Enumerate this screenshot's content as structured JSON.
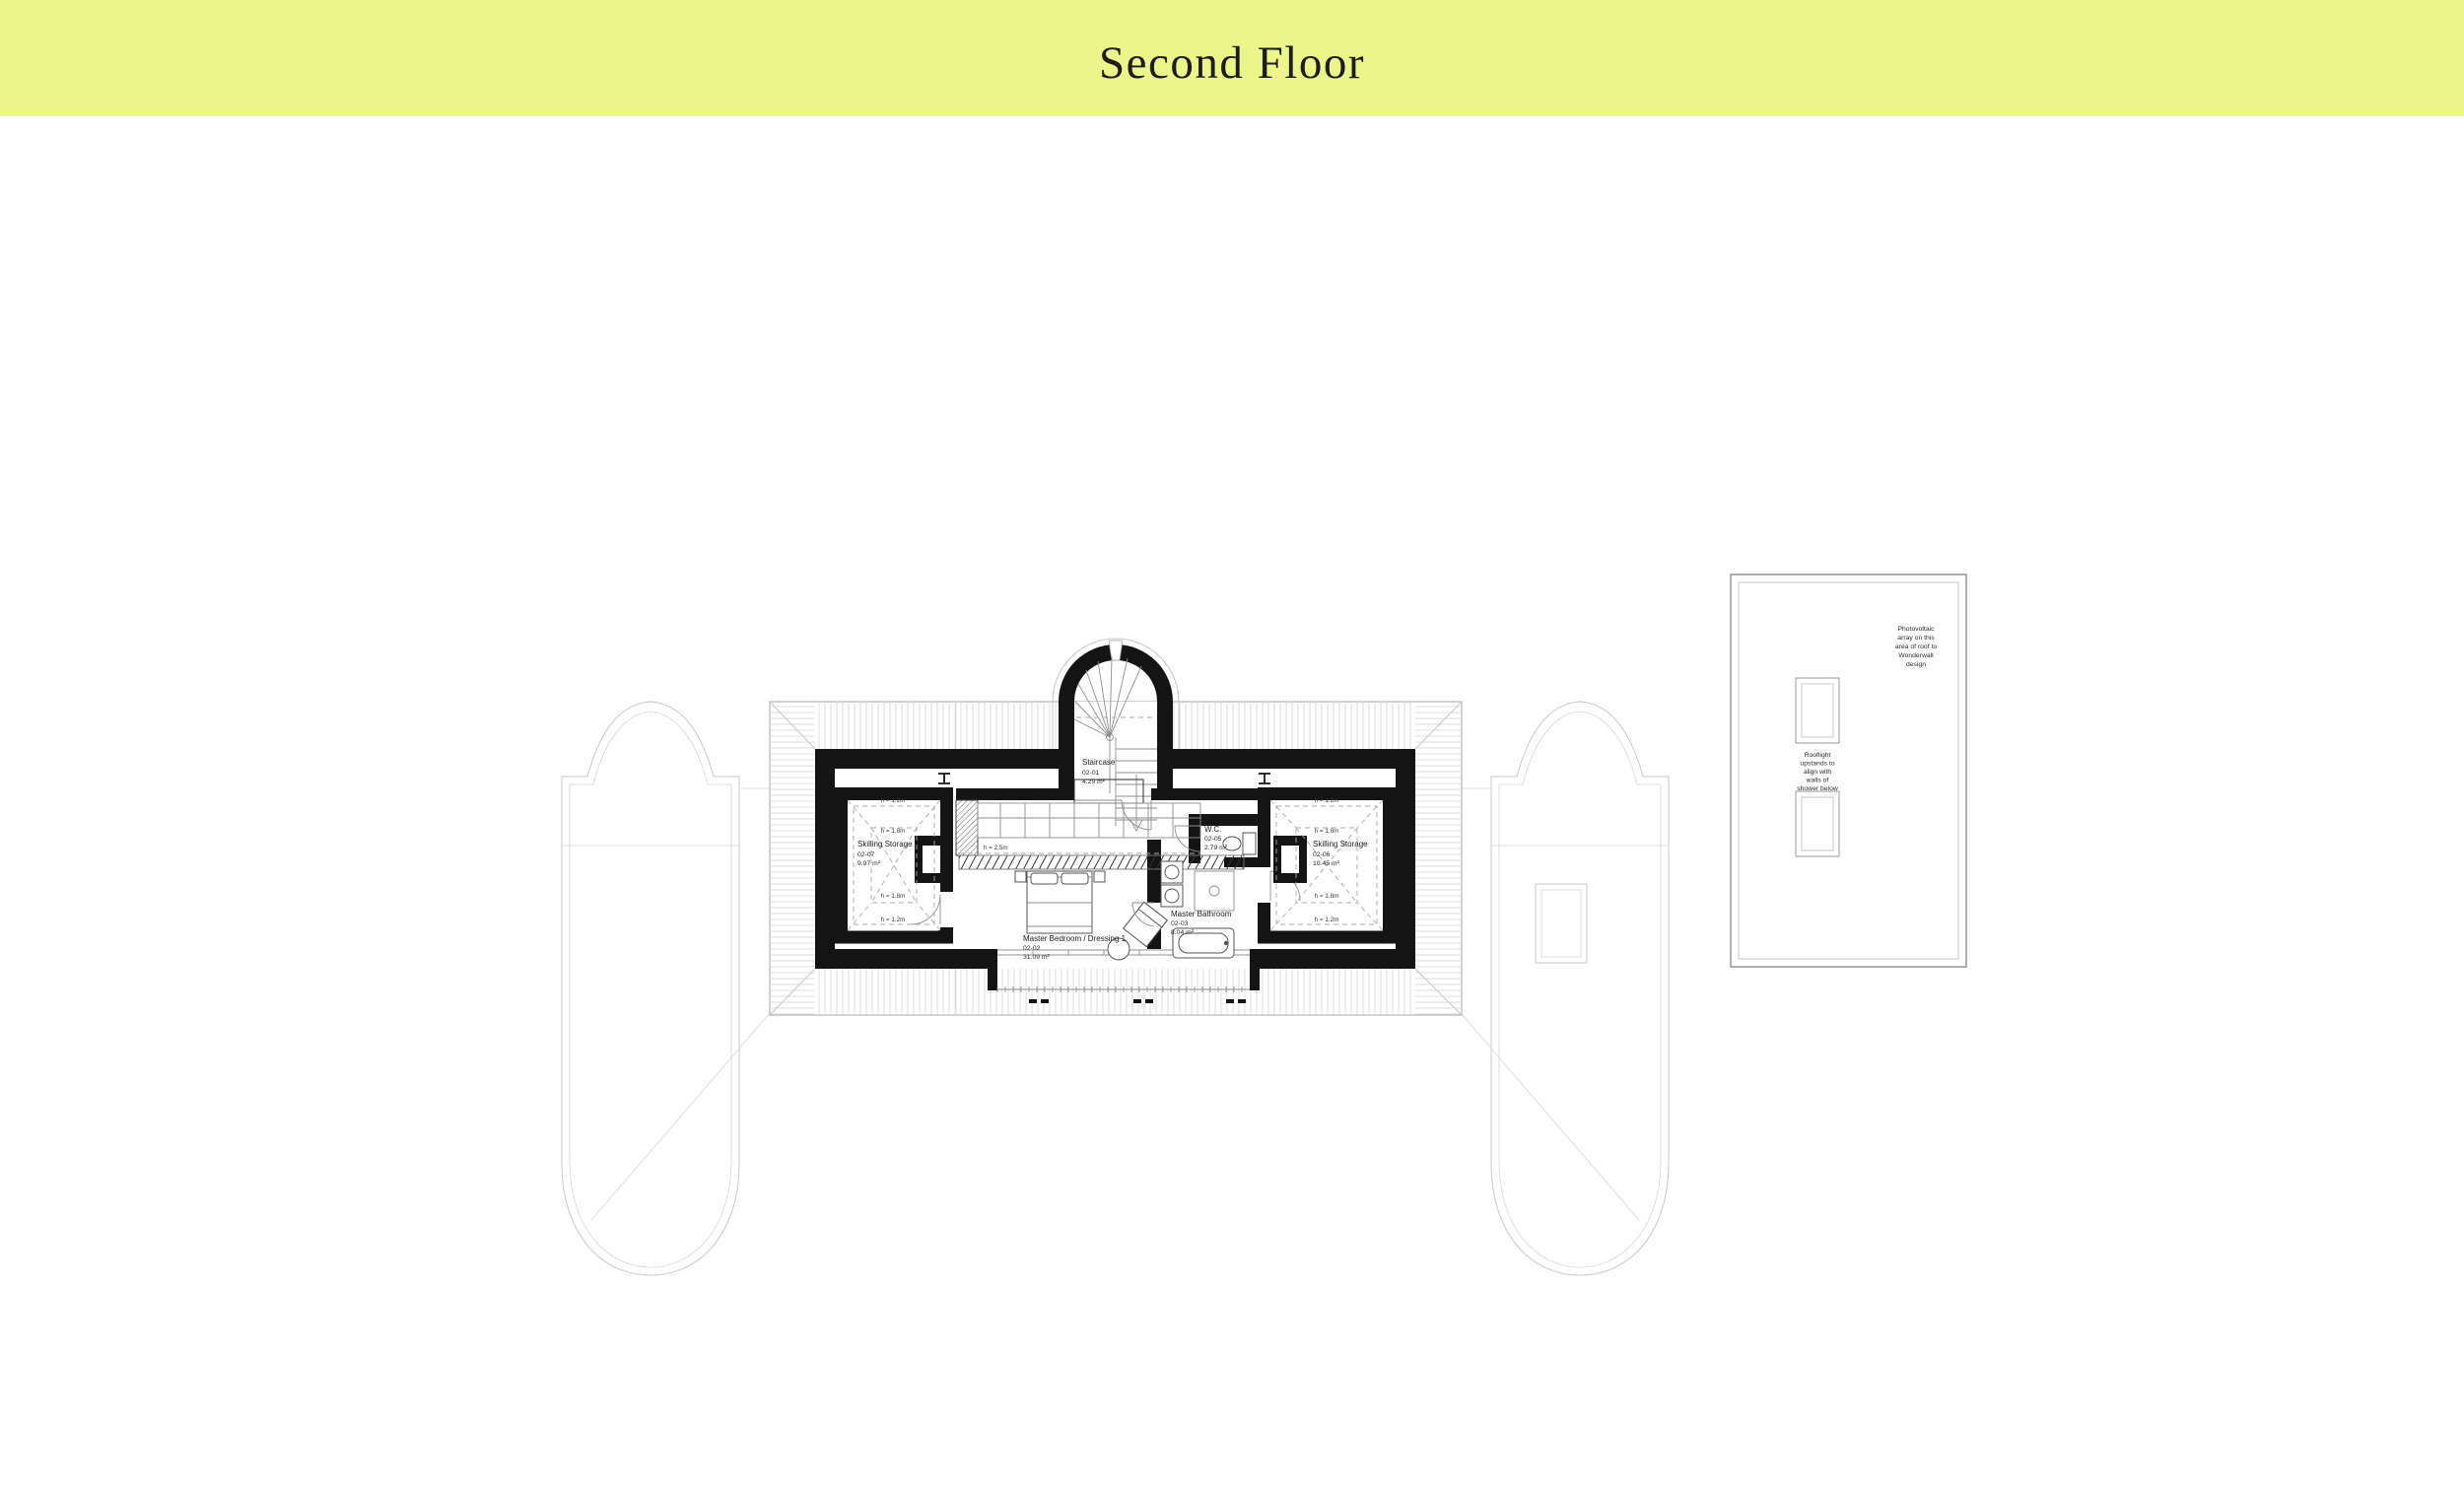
{
  "header": {
    "title": "Second Floor"
  },
  "colors": {
    "banner_bg": "#ebf689",
    "title_text": "#222a18",
    "wall": "#141414"
  },
  "floor_plan": {
    "rooms": [
      {
        "name": "Staircase",
        "number": "02-01",
        "area": "4.29 m²"
      },
      {
        "name": "Master Bedroom / Dressing 1",
        "number": "02-02",
        "area": "31.09 m²"
      },
      {
        "name": "Master Bathroom",
        "number": "02-03",
        "area": "8.04 m²"
      },
      {
        "name": "W.C.",
        "number": "02-05",
        "area": "2.79 m²"
      },
      {
        "name": "Skilling Storage",
        "number": "02-06",
        "area": "10.45 m²"
      },
      {
        "name": "Skilling Storage",
        "number": "02-07",
        "area": "9.97 m²"
      }
    ],
    "height_labels": {
      "h12": "h = 1.2m",
      "h18": "h = 1.8m",
      "h25": "h = 2.5m"
    }
  },
  "roof_plan": {
    "pv_note_lines": [
      "Photovoltaic",
      "array on this",
      "area of roof to",
      "Wonderwall",
      "design"
    ],
    "rooflight_note_lines": [
      "Rooflight",
      "upstands to",
      "align with",
      "walls of",
      "shower below"
    ]
  }
}
